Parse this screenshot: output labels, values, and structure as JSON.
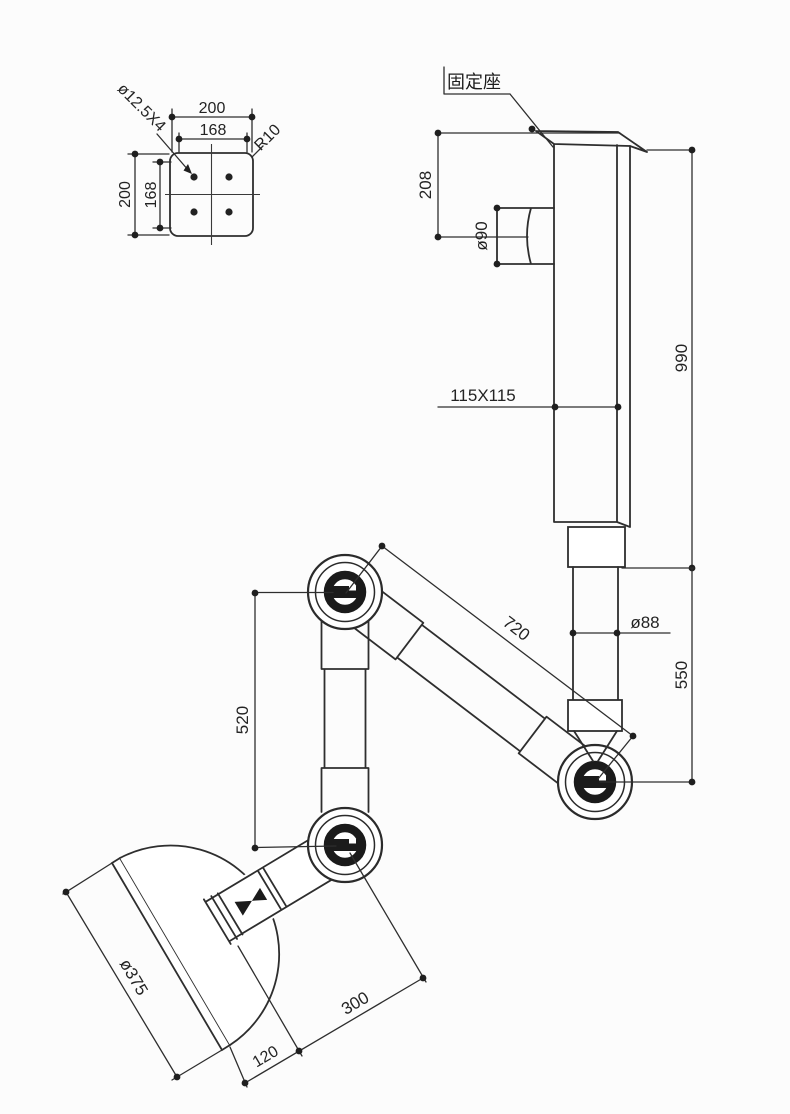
{
  "drawing": {
    "mount_plate": {
      "dim_width_outer": "200",
      "dim_width_inner": "168",
      "dim_height_outer": "200",
      "dim_height_inner": "168",
      "holes_label": "ø12.5X4",
      "corner_radius": "R10"
    },
    "column": {
      "mount_label": "固定座",
      "dim_top_offset": "208",
      "port_diameter": "ø90",
      "dim_column_height": "990",
      "cross_section": "115X115",
      "tube_diameter": "ø88",
      "dim_lower_height": "550"
    },
    "arm": {
      "dim_upper_arm": "720",
      "dim_forearm": "520"
    },
    "hood": {
      "dome_diameter": "ø375",
      "dim_neck_length": "300",
      "dim_flange_depth": "120"
    }
  }
}
